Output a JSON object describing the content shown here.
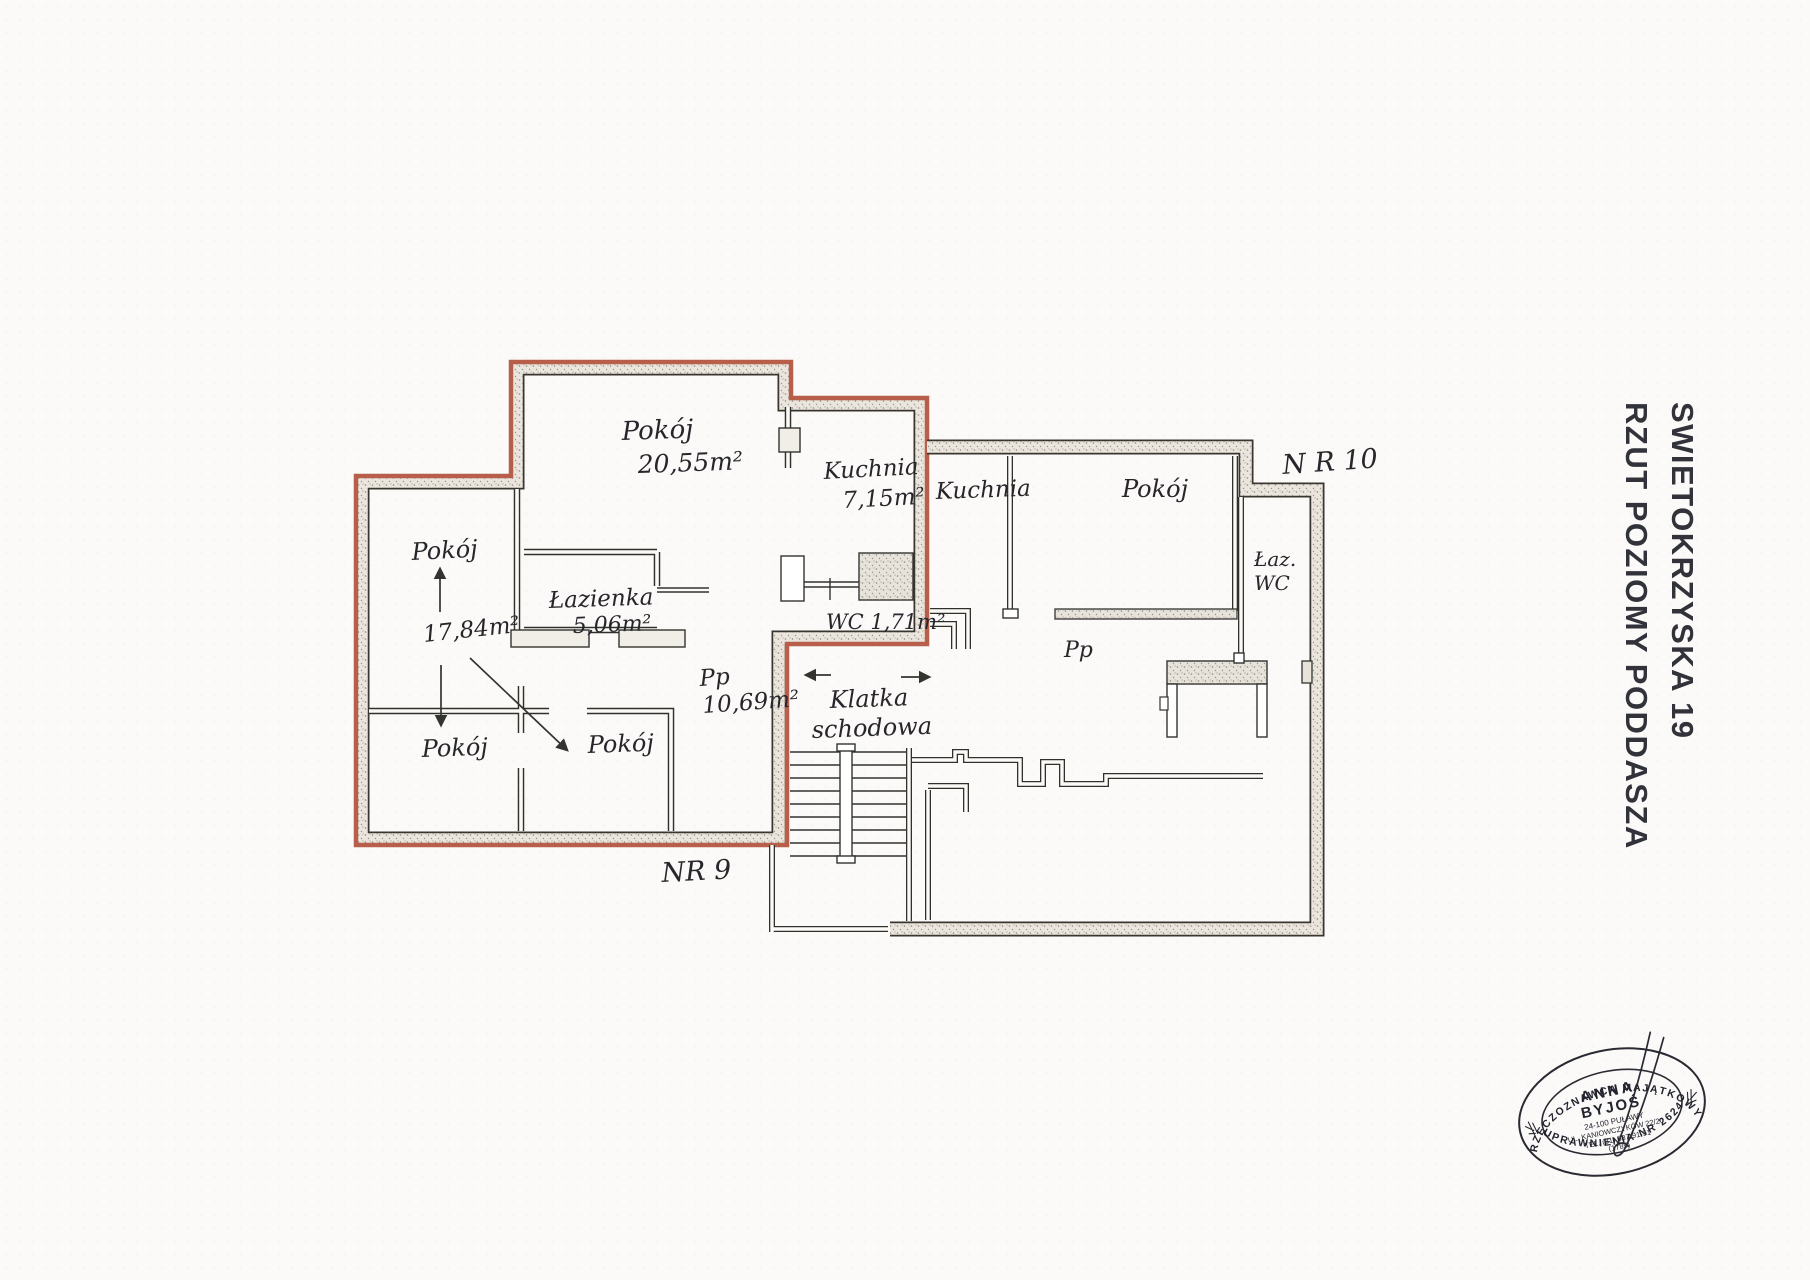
{
  "title": {
    "line1": "SWIETOKRZYSKA 19",
    "line2": "RZUT POZIOMY PODDASZA"
  },
  "apartments": {
    "nr9": {
      "label": "NR 9",
      "pokoj_main": {
        "name": "Pokój",
        "area": "20,55m²"
      },
      "kuchnia": {
        "name": "Kuchnia",
        "area": "7,15m²"
      },
      "lazienka": {
        "name": "Łazienka",
        "area": "5,06m²"
      },
      "wc": {
        "label": "WC 1,71m²"
      },
      "przedpokoj": {
        "name": "Pp",
        "area": "10,69m²"
      },
      "pokoj_left": {
        "name": "Pokój",
        "area": "17,84m²"
      },
      "pokoj_bottom_left": {
        "name": "Pokój"
      },
      "pokoj_bottom_center": {
        "name": "Pokój"
      }
    },
    "nr10": {
      "label": "N R 10",
      "kuchnia": {
        "name": "Kuchnia"
      },
      "pokoj": {
        "name": "Pokój"
      },
      "lazienka_wc": {
        "line1": "Łaz.",
        "line2": "WC"
      },
      "przedpokoj": {
        "name": "Pp"
      }
    }
  },
  "staircase": {
    "line1": "Klatka",
    "line2": "schodowa"
  },
  "stamp": {
    "arc_top": "RZECZOZNAWCA MAJĄTKOWY",
    "name_line1": "ANNA",
    "name_line2": "BYJOŚ",
    "address_line1": "24-100 PUŁAWY",
    "address_line2": "UL. KANIOWCZYKÓW 22/20",
    "phone": "TEL. (81) 887-91-51",
    "code": "(1785)",
    "arc_bottom": "UPRAWNIENIA NR 2624"
  },
  "colors": {
    "apartment9_outline": "#b85f4b",
    "wall_fill": "#e9e5dd",
    "ink": "#2d2d2d",
    "stamp_ink": "#23232e"
  }
}
